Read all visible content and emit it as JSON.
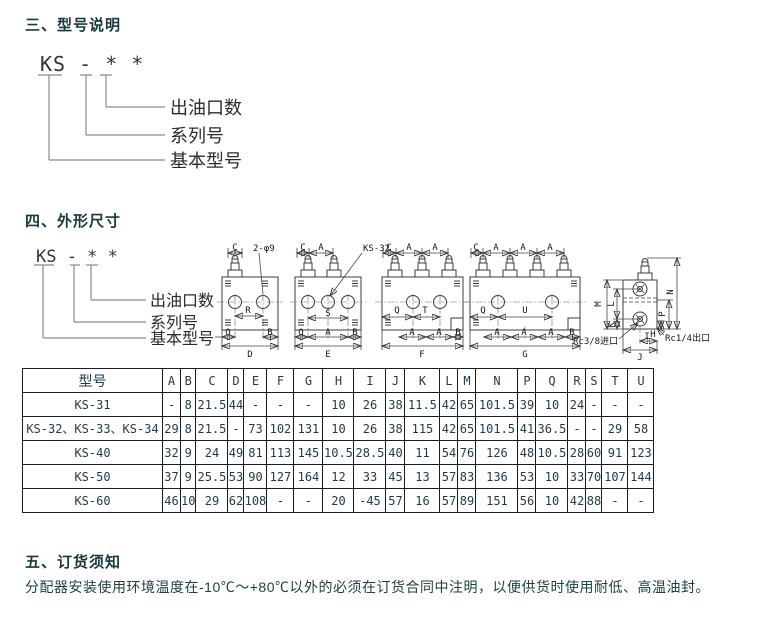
{
  "sections": {
    "s3": {
      "heading": "三、型号说明"
    },
    "s4": {
      "heading": "四、外形尺寸"
    },
    "s5": {
      "heading": "五、订货须知",
      "body": "分配器安装使用环境温度在-10℃～+80℃以外的必须在订货合同中注明，以便供货时使用耐低、高温油封。"
    }
  },
  "model_diagram": {
    "display": "KS - * *",
    "labels": {
      "outlets": "出油口数",
      "series": "系列号",
      "base": "基本型号"
    }
  },
  "drawings": {
    "d1": {
      "c": "C",
      "callout": "2-φ9",
      "r": "R",
      "q": "Q",
      "b": "B",
      "d": "D"
    },
    "d2": {
      "c": "C",
      "a1": "A",
      "callout": "KS-32",
      "s": "S",
      "q": "Q",
      "a2": "A",
      "b": "B",
      "e": "E"
    },
    "d3": {
      "c": "C",
      "a1": "A",
      "a2": "A",
      "q": "Q",
      "t": "T",
      "a3": "A",
      "a4": "A",
      "b": "B",
      "f": "F"
    },
    "d4": {
      "c": "C",
      "a1": "A",
      "a2": "A",
      "a3": "A",
      "q": "Q",
      "u": "U",
      "a4": "A",
      "a5": "A",
      "a6": "A",
      "b": "B",
      "g": "G"
    },
    "d5": {
      "m": "M",
      "l": "L",
      "k": "K",
      "n": "N",
      "p": "P",
      "h": "H",
      "i": "I",
      "j": "J",
      "inlet": "Rc3/8进口",
      "outlet": "Rc1/4出口"
    }
  },
  "table": {
    "columns": [
      "型号",
      "A",
      "B",
      "C",
      "D",
      "E",
      "F",
      "G",
      "H",
      "I",
      "J",
      "K",
      "L",
      "M",
      "N",
      "P",
      "Q",
      "R",
      "S",
      "T",
      "U"
    ],
    "rows": [
      [
        "KS-31",
        "-",
        "8",
        "21.5",
        "44",
        "-",
        "-",
        "-",
        "10",
        "26",
        "38",
        "11.5",
        "42",
        "65",
        "101.5",
        "39",
        "10",
        "24",
        "-",
        "-",
        "-"
      ],
      [
        "KS-32、KS-33、KS-34",
        "29",
        "8",
        "21.5",
        "-",
        "73",
        "102",
        "131",
        "10",
        "26",
        "38",
        "115",
        "42",
        "65",
        "101.5",
        "41",
        "36.5",
        "-",
        "-",
        "29",
        "58"
      ],
      [
        "KS-40",
        "32",
        "9",
        "24",
        "49",
        "81",
        "113",
        "145",
        "10.5",
        "28.5",
        "40",
        "11",
        "54",
        "76",
        "126",
        "48",
        "10.5",
        "28",
        "60",
        "91",
        "123"
      ],
      [
        "KS-50",
        "37",
        "9",
        "25.5",
        "53",
        "90",
        "127",
        "164",
        "12",
        "33",
        "45",
        "13",
        "57",
        "83",
        "136",
        "53",
        "10",
        "33",
        "70",
        "107",
        "144"
      ],
      [
        "KS-60",
        "46",
        "10",
        "29",
        "62",
        "108",
        "-",
        "-",
        "20",
        "-45",
        "57",
        "16",
        "57",
        "89",
        "151",
        "56",
        "10",
        "42",
        "88",
        "-",
        "-"
      ]
    ]
  }
}
